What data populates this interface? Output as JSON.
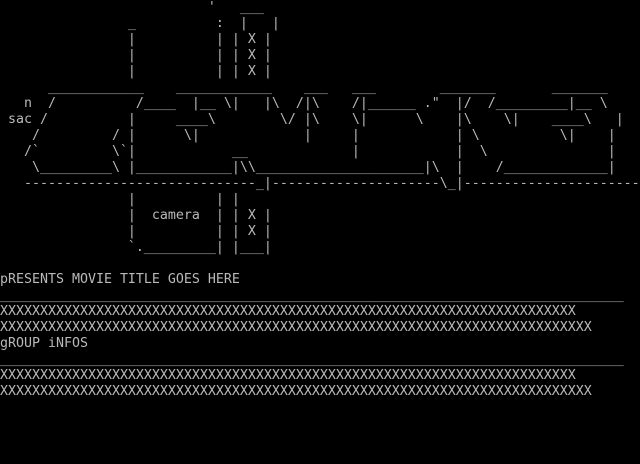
{
  "screen": {
    "background_color": "#000000",
    "foreground_color": "#b9b9b9",
    "logo": {
      "signature": "n sac",
      "camera_label": "camera",
      "film_strip_hole_char": "X",
      "lines": [
        "                          '   ___",
        "                _          :  |   |",
        "                |          | | X |",
        "                |          | | X |",
        "                |          | | X |",
        "      ____________    ____________    ___   ___        _______       _______",
        "   n  /          /____  |__ \\|   |\\  /|\\    /|______ .\"  |/  /_________|__ \\",
        " sac /          |     ____\\        \\/ |\\    \\|      \\    |\\    \\|    ____\\   |",
        "    /         / |      \\|             |     |            | \\          \\|    |",
        "   /`         \\`|            __             |            |  \\               |",
        "    \\_________\\ |____________|\\\\_____________________|\\  |    /_____________|",
        "   -----------------------------_|---------------------\\_|----------------------",
        "                |          | |",
        "                |  camera  | | X |",
        "                |          | | X |",
        "                `._________| |___|",
        "",
        ""
      ]
    },
    "presents": {
      "text": "pRESENTS MOVIE TITLE GOES HERE"
    },
    "rule": "______________________________________________________________________________",
    "info_rows": {
      "lines": [
        "XXXXXXXXXXXXXXXXXXXXXXXXXXXXXXXXXXXXXXXXXXXXXXXXXXXXXXXXXXXXXXXXXXXXXXXX",
        "XXXXXXXXXXXXXXXXXXXXXXXXXXXXXXXXXXXXXXXXXXXXXXXXXXXXXXXXXXXXXXXXXXXXXXXXXX"
      ]
    },
    "group": {
      "text": "gROUP iNFOS"
    }
  }
}
